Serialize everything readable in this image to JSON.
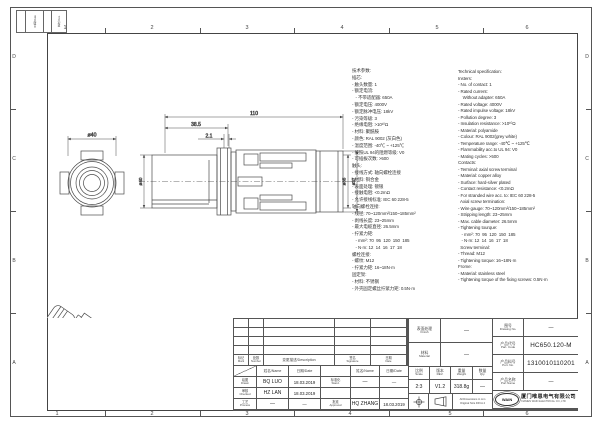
{
  "sheet": {
    "zone_numbers": [
      "1",
      "2",
      "3",
      "4",
      "5",
      "6"
    ],
    "zone_letters": [
      "D",
      "C",
      "B",
      "A"
    ],
    "fold_strip": {
      "date": "日期/Date",
      "des": "更改 Des."
    },
    "line_color": "#4a4a4a",
    "paper_color": "#ffffff"
  },
  "drawing": {
    "dims": {
      "front_dia": "ø40",
      "side_dia": "ø40",
      "total_len": "110",
      "flange_pos": "38.5",
      "groove": "2.1",
      "dia35": "ø35",
      "dia37": "ø37"
    }
  },
  "spec_cn": {
    "lines": [
      "技术参数:",
      "插芯:",
      "- 触头数量: 1",
      "- 额定电流:",
      "   - 不带适配器: 650A",
      "- 额定电压: 4000V",
      "- 额定脉冲电压: 18kV",
      "- 污染等级: 3",
      "- 绝缘电阻: >10¹⁰Ω",
      "- 材料: 聚酰胺",
      "- 颜色: RAL 9002 (灰白色)",
      "- 温度范围: -40℃ ~ +125℃",
      "- 按照UL 94的阻燃等级: V0",
      "- 可插拔次数: >500",
      "触头:",
      "- 接线方式: 轴向螺栓连接",
      "- 材料: 铜合金",
      "- 表面处理: 镀银",
      "- 接触电阻: <0.2mΩ",
      "- 允许接线标准: IEC 60 228-5",
      "轴向螺栓连接:",
      "- 线径: 70~120mm²/150~185mm²",
      "- 剥线长度: 23~25mm",
      "- 最大电缆直径: 26.5mm",
      "- 拧紧力矩:",
      "   - mm²: 70  95  120  150  185",
      "   - N·m: 12  14  16  17  18",
      "螺栓连接:",
      "- 螺纹: M12",
      "- 拧紧力矩: 16~18N·m",
      "固定架:",
      "- 材料: 不锈钢",
      "- 外壳固定螺丝拧紧力矩: 0.5N·m"
    ]
  },
  "spec_en": {
    "lines": [
      "Technical specification:",
      "Insters:",
      "- No. of contact: 1",
      "- Rated current:",
      "    Without adapter: 650A",
      "- Rated voltage: 4000V",
      "- Rated impulse voltage: 18kV",
      "- Pollution degree: 3",
      "- Insulation resistance: >10¹⁰Ω",
      "- Material: polyamide",
      "- Colour: RAL 9002(grey white)",
      "- Temperature range: -40℃ ~ +125℃",
      "- Flammability acc.to UL 94: V0",
      "- Mating cycles: >500",
      "Contacts:",
      "- Terminal: axial screw terminal",
      "- Material: copper alloy",
      "- Surface: hard-silver plated",
      "- Contact resistance: <0.2mΩ",
      "- For stranded wire acc. to: IEC 60 228-5",
      "  Axial screw termination:",
      "- Wire gauge: 70~120mm²/150~185mm²",
      "- Stripping length: 23~25mm",
      "- Max. cable diameter: 26.5mm",
      "- Tightening tourque:",
      "   - mm²: 70  95  120  150  185",
      "   - N·m: 12  14  16  17  18",
      "  Screw terminal:",
      "- Thread: M12",
      "- Tightening torque: 16~18N·m",
      "Frome:",
      "- Material: stainless steel",
      "- Tightening torque of the fixing screws: 0.5N·m"
    ]
  },
  "titleblock": {
    "revision": {
      "mark_cn": "标记",
      "mark_en": "Mark",
      "number_cn": "处数",
      "number_en": "Number",
      "description": "变更描述/Description",
      "signature_cn": "签名",
      "signature_en": "Signature",
      "date_cn": "日期",
      "date_en": "Date",
      "name_label": "姓名/Name",
      "date_label": "日期/Date"
    },
    "approvals": {
      "drawn_cn": "绘图",
      "drawn_en": "Drawn",
      "drawn_name": "BQ LUO",
      "drawn_date": "18.03.2019",
      "checked_cn": "审核",
      "checked_en": "Checked",
      "checked_name": "HZ LAN",
      "checked_date": "18.03.2019",
      "process_cn": "工艺",
      "process_en": "Process",
      "process_name": "—",
      "process_date": "—",
      "stand_cn": "标准化",
      "stand_en": "Stand.",
      "stand_name": "—",
      "stand_date": "—",
      "approved_cn": "批准",
      "approved_en": "Approved",
      "approved_name": "HQ ZHANG",
      "approved_date": "18.03.2019"
    },
    "fields": {
      "finish_cn": "表面处理",
      "finish_en": "Finish",
      "finish_val": "—",
      "material_cn": "材料",
      "material_en": "Material",
      "material_val": "—",
      "scale_cn": "比例",
      "scale_en": "Scale",
      "scale_val": "2:3",
      "rev_cn": "版本",
      "rev_en": "REV.",
      "rev_val": "V1.2",
      "weight_cn": "重量",
      "weight_en": "Weight",
      "weight_val": "318.8g",
      "qty_cn": "数量",
      "qty_en": "Qty.",
      "qty_val": "—",
      "dims_note_1": "All Dimensions in mm",
      "dims_note_2": "Original Size DIN A 4"
    },
    "part": {
      "drawing_no_cn": "图号",
      "drawing_no_en": "Drawing No.",
      "drawing_no_val": "—",
      "part_code_cn": "产品代号",
      "part_code_en": "Part. Code",
      "part_code_val": "HC650.120-M",
      "part_no_cn": "产品料号",
      "part_no_en": "Port. No.",
      "part_no_val": "1310010110201",
      "part_name_cn": "产品名称",
      "part_name_en": "Port Name",
      "part_name_val": "—"
    },
    "company": {
      "logo": "WAIN",
      "name_cn": "厦门唯恩电气有限公司",
      "name_en": "XIAMEN WAIN ELECTRICAL CO.,LTD"
    }
  }
}
